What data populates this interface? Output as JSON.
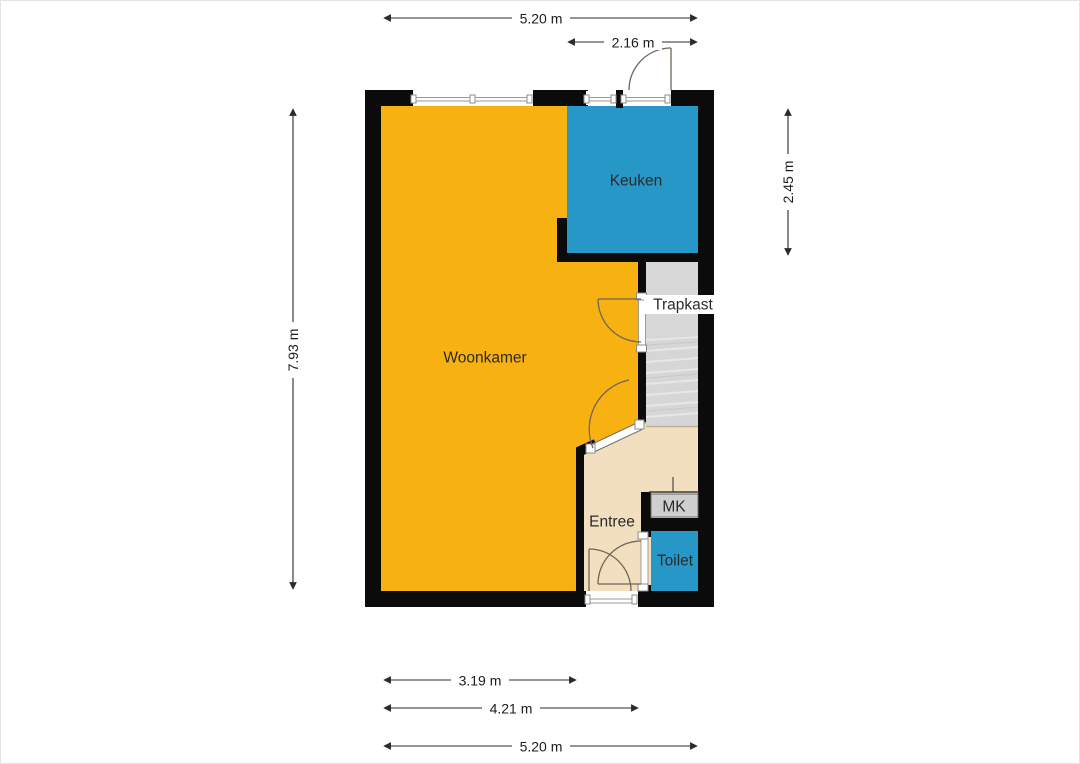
{
  "plan": {
    "rooms": [
      {
        "id": "woonkamer",
        "label": "Woonkamer"
      },
      {
        "id": "keuken",
        "label": "Keuken"
      },
      {
        "id": "trapkast",
        "label": "Trapkast"
      },
      {
        "id": "entree",
        "label": "Entree"
      },
      {
        "id": "mk",
        "label": "MK"
      },
      {
        "id": "toilet",
        "label": "Toilet"
      }
    ],
    "dimensions": [
      {
        "id": "top-width",
        "label": "5.20 m"
      },
      {
        "id": "kitchen-width",
        "label": "2.16 m"
      },
      {
        "id": "left-height",
        "label": "7.93 m"
      },
      {
        "id": "kitchen-height",
        "label": "2.45 m"
      },
      {
        "id": "living-width",
        "label": "3.19 m"
      },
      {
        "id": "hall-width",
        "label": "4.21 m"
      },
      {
        "id": "bottom-width",
        "label": "5.20 m"
      }
    ],
    "colors": {
      "wall": "#0b0b0b",
      "living_room": "#f7b110",
      "kitchen": "#2697c7",
      "toilet": "#2697c7",
      "hallway": "#f2dfc0",
      "closet": "#d8d8d8",
      "stairs": "#d6d6d6",
      "meter_cupboard_door": "#cfcfcf",
      "door_swing": "#70655a",
      "dimension_line": "#2b2b2b"
    }
  }
}
